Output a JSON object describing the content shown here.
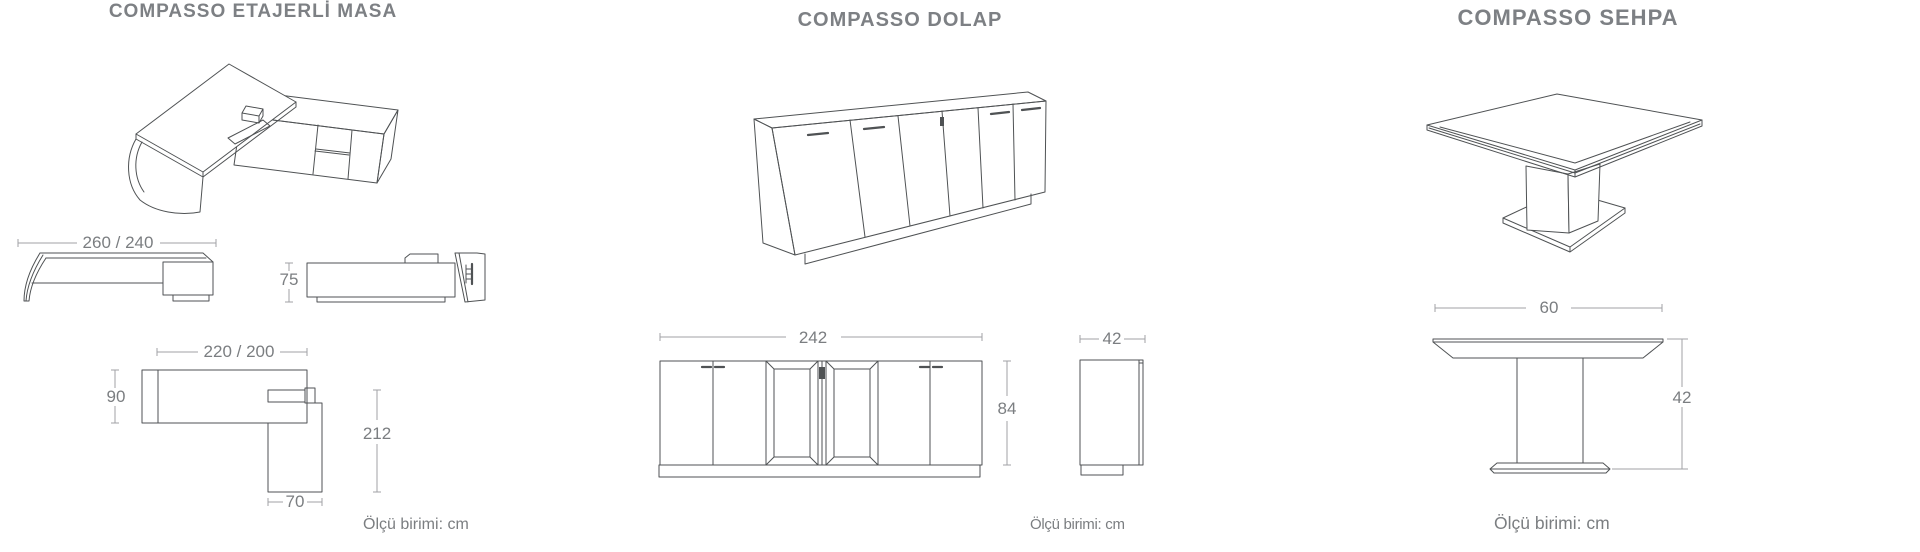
{
  "page": {
    "background": "#ffffff",
    "line_color": "#4f5254",
    "dim_line_color": "#a0a2a5",
    "dim_text_color": "#7b7e81",
    "title_color": "#7d8084"
  },
  "products": [
    {
      "title": "COMPASSO ETAJERLİ MASA",
      "unit_note": "Ölçü birimi: cm",
      "dimensions": {
        "total_width": "260 / 240",
        "height": "75",
        "desk_width": "220 / 200",
        "desk_depth": "90",
        "return_length": "212",
        "return_width": "70"
      }
    },
    {
      "title": "COMPASSO DOLAP",
      "unit_note": "Ölçü birimi: cm",
      "dimensions": {
        "width": "242",
        "height": "84",
        "depth": "42"
      }
    },
    {
      "title": "COMPASSO SEHPA",
      "unit_note": "Ölçü birimi: cm",
      "dimensions": {
        "width": "60",
        "height": "42"
      }
    }
  ]
}
